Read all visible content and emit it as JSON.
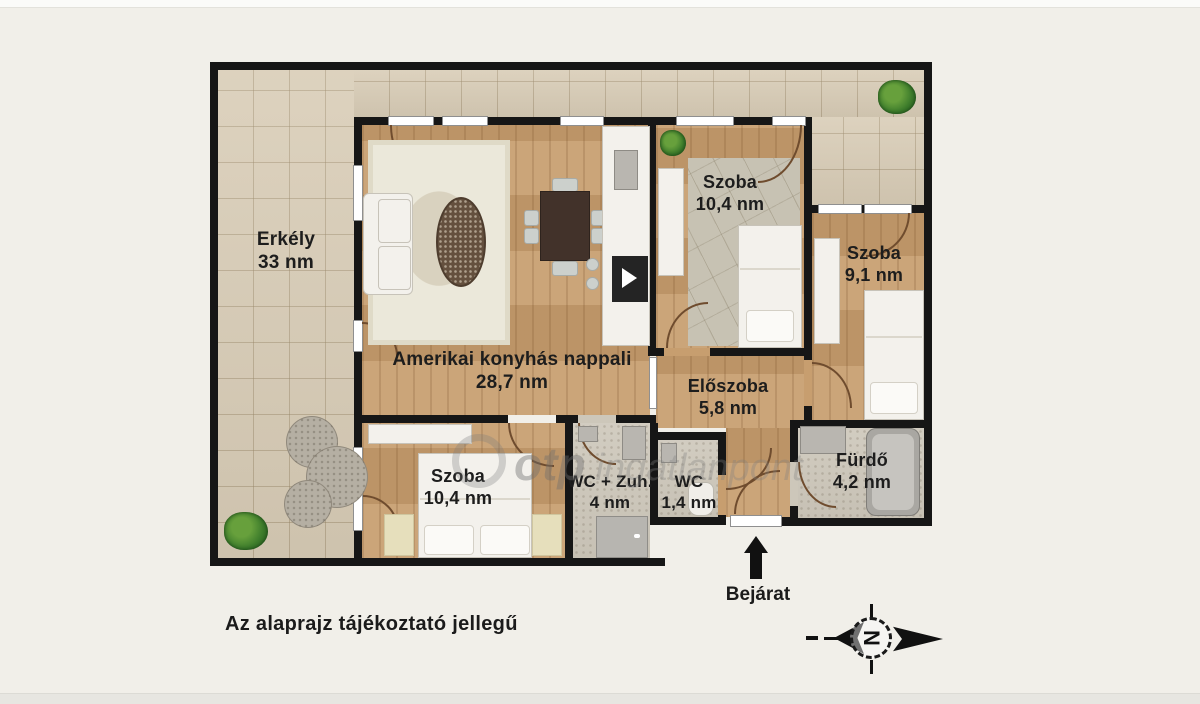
{
  "page": {
    "disclaimer": "Az alaprajz tájékoztató jellegű"
  },
  "watermark": {
    "brand": "otp",
    "suffix": "ingatlanpont"
  },
  "entrance": {
    "label": "Bejárat"
  },
  "compass": {
    "letter": "N"
  },
  "rooms": {
    "erkely": {
      "name": "Erkély",
      "area": "33 nm"
    },
    "nappali": {
      "name": "Amerikai konyhás nappali",
      "area": "28,7 nm"
    },
    "szoba_felso": {
      "name": "Szoba",
      "area": "10,4 nm"
    },
    "szoba_jobb": {
      "name": "Szoba",
      "area": "9,1 nm"
    },
    "eloszoba": {
      "name": "Előszoba",
      "area": "5,8 nm"
    },
    "szoba_also": {
      "name": "Szoba",
      "area": "10,4 nm"
    },
    "wc_zuhany": {
      "name": "WC + Zuh.",
      "area": "4 nm"
    },
    "wc": {
      "name": "WC",
      "area": "1,4 nm"
    },
    "furdo": {
      "name": "Fürdő",
      "area": "4,2 nm"
    }
  },
  "colors": {
    "wall": "#161616",
    "wood_floor": "#c79e6f",
    "balcony_tile": "#d9cdb7",
    "bath_tile": "#cdc7ba",
    "background": "#f1efe9",
    "plant_green": "#3e7d2c",
    "door_arc": "#6f4c2e"
  }
}
